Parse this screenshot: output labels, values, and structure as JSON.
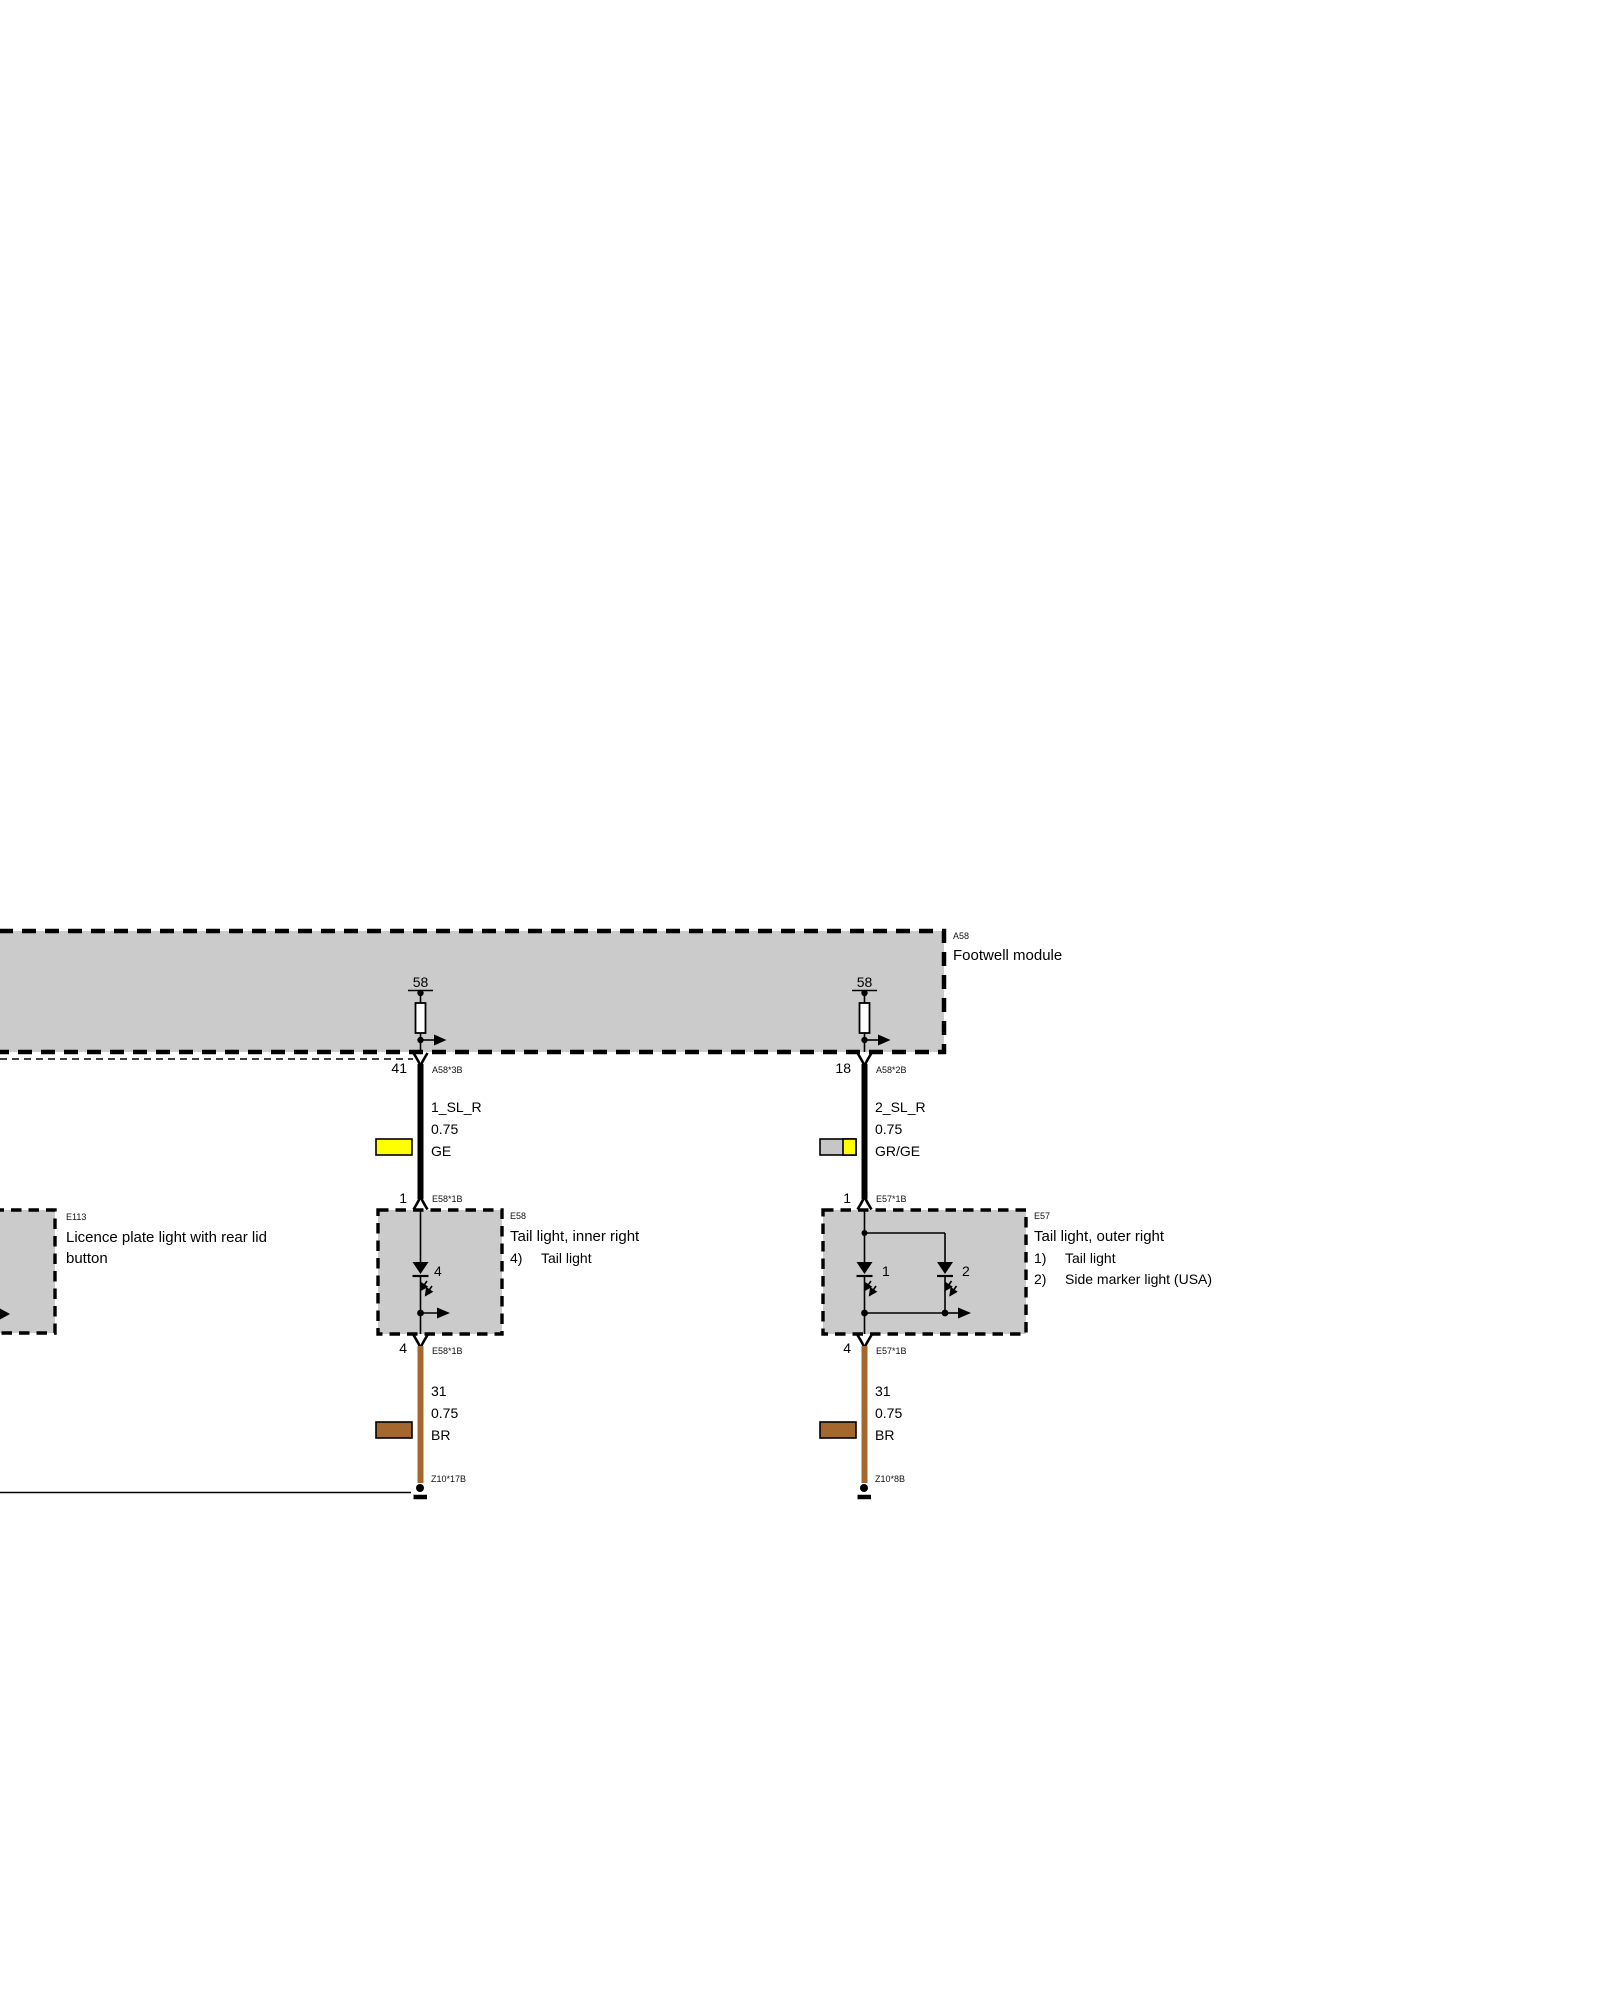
{
  "colors": {
    "box_fill": "#cbcbcb",
    "ge_yellow": "#ffff00",
    "gr_gray": "#c6c6c6",
    "br_brown": "#a4682f",
    "wire_black": "#000000"
  },
  "module_a58": {
    "code": "A58",
    "name": "Footwell module",
    "terminal_left": "58",
    "terminal_right": "58"
  },
  "component_e113": {
    "code": "E113",
    "name_line1": "Licence plate light with rear lid",
    "name_line2": "button"
  },
  "component_e58": {
    "code": "E58",
    "name": "Tail light, inner right",
    "led_label": "4",
    "legend": [
      {
        "num": "4)",
        "label": "Tail light"
      }
    ]
  },
  "component_e57": {
    "code": "E57",
    "name": "Tail light, outer right",
    "led1_label": "1",
    "led2_label": "2",
    "legend": [
      {
        "num": "1)",
        "label": "Tail light"
      },
      {
        "num": "2)",
        "label": "Side marker light (USA)"
      }
    ]
  },
  "wire_left_upper": {
    "pin_out": "41",
    "conn_out": "A58*3B",
    "name": "1_SL_R",
    "size": "0.75",
    "color": "GE",
    "pin_in": "1",
    "conn_in": "E58*1B"
  },
  "wire_right_upper": {
    "pin_out": "18",
    "conn_out": "A58*2B",
    "name": "2_SL_R",
    "size": "0.75",
    "color": "GR/GE",
    "pin_in": "1",
    "conn_in": "E57*1B"
  },
  "wire_left_lower": {
    "pin_out": "4",
    "conn_out": "E58*1B",
    "name": "31",
    "size": "0.75",
    "color": "BR",
    "ground_code": "Z10*17B"
  },
  "wire_right_lower": {
    "pin_out": "4",
    "conn_out": "E57*1B",
    "name": "31",
    "size": "0.75",
    "color": "BR",
    "ground_code": "Z10*8B"
  }
}
